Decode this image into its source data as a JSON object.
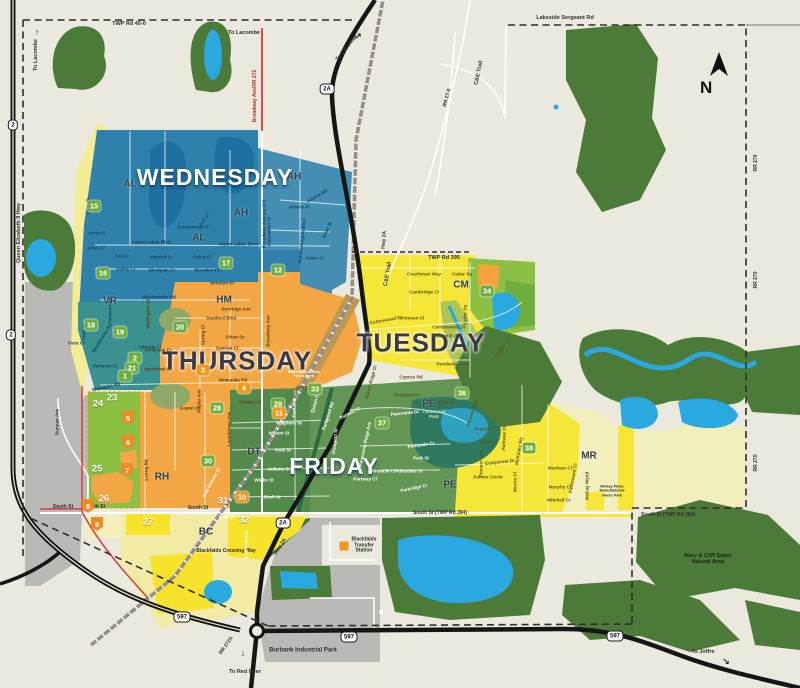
{
  "compass": {
    "letter": "N"
  },
  "colors": {
    "background": "#ebe9dd",
    "wednesday_blue": "#2f81ab",
    "vr_teal": "#3b9190",
    "thursday_orange": "#f2a644",
    "tuesday_yellow": "#f6e637",
    "friday_green": "#639554",
    "pale_yellow": "#f3efbc",
    "park_green": "#8cc043",
    "forest_green": "#4c7a38",
    "water_blue": "#2aa9e0",
    "industrial_gray": "#b9b9b5",
    "red_road": "#d63b3b"
  },
  "labels": [
    {
      "t": "WEDNESDAY",
      "x": 215,
      "y": 178,
      "c": "W",
      "s": 23
    },
    {
      "t": "THURSDAY",
      "x": 237,
      "y": 361,
      "c": "D",
      "s": 26
    },
    {
      "t": "TUESDAY",
      "x": 421,
      "y": 343,
      "c": "D",
      "s": 26
    },
    {
      "t": "FRIDAY",
      "x": 334,
      "y": 467,
      "c": "W",
      "s": 23
    },
    {
      "t": "AL",
      "x": 130,
      "y": 184,
      "c": "Z",
      "s": 10
    },
    {
      "t": "AH",
      "x": 294,
      "y": 177,
      "c": "Z",
      "s": 10
    },
    {
      "t": "AH",
      "x": 241,
      "y": 213,
      "c": "Z",
      "s": 10
    },
    {
      "t": "AL",
      "x": 199,
      "y": 238,
      "c": "Z",
      "s": 10
    },
    {
      "t": "VR",
      "x": 110,
      "y": 301,
      "c": "Z",
      "s": 10
    },
    {
      "t": "HM",
      "x": 224,
      "y": 300,
      "c": "Z",
      "s": 10
    },
    {
      "t": "CM",
      "x": 461,
      "y": 285,
      "c": "Z",
      "s": 10
    },
    {
      "t": "DT",
      "x": 254,
      "y": 452,
      "c": "Z",
      "s": 10
    },
    {
      "t": "PE",
      "x": 429,
      "y": 404,
      "c": "Z",
      "s": 10
    },
    {
      "t": "PE",
      "x": 450,
      "y": 485,
      "c": "Z",
      "s": 10
    },
    {
      "t": "MR",
      "x": 589,
      "y": 456,
      "c": "Z",
      "s": 10
    },
    {
      "t": "RH",
      "x": 162,
      "y": 477,
      "c": "Z",
      "s": 10
    },
    {
      "t": "BC",
      "x": 206,
      "y": 532,
      "c": "Z",
      "s": 10
    },
    {
      "t": "TWP Rd 40-0",
      "x": 129,
      "y": 24,
      "c": "d",
      "s": 5.5
    },
    {
      "t": "Lakeside Sergeant Rd",
      "x": 565,
      "y": 18,
      "c": "d",
      "s": 5.5
    },
    {
      "t": "TWP Rd 395",
      "x": 444,
      "y": 258,
      "c": "d",
      "s": 5.5
    },
    {
      "t": "C&E Trail",
      "x": 479,
      "y": 73,
      "r": -78,
      "c": "d",
      "s": 5.5
    },
    {
      "t": "C&E Trail",
      "x": 388,
      "y": 274,
      "r": -80,
      "c": "d",
      "s": 5.5
    },
    {
      "t": "RR 27-0",
      "x": 448,
      "y": 98,
      "r": -75,
      "c": "d",
      "s": 5
    },
    {
      "t": "Queen Elizabeth II Hwy",
      "x": 19,
      "y": 233,
      "r": -90,
      "c": "d",
      "s": 5.5
    },
    {
      "t": "Hwy 2A",
      "x": 385,
      "y": 240,
      "r": -85,
      "c": "d",
      "s": 5
    },
    {
      "t": "Hwy 2A",
      "x": 281,
      "y": 547,
      "r": -58,
      "c": "d",
      "s": 5
    },
    {
      "t": "RR 270",
      "x": 757,
      "y": 163,
      "r": -90,
      "c": "d",
      "s": 5
    },
    {
      "t": "RR 270",
      "x": 757,
      "y": 280,
      "r": -90,
      "c": "d",
      "s": 5
    },
    {
      "t": "RR 270",
      "x": 757,
      "y": 463,
      "r": -90,
      "c": "d",
      "s": 5
    },
    {
      "t": "RR 272A",
      "x": 227,
      "y": 646,
      "r": -55,
      "c": "d",
      "s": 5
    },
    {
      "t": "South St",
      "x": 63,
      "y": 508,
      "c": "d",
      "s": 5
    },
    {
      "t": "South St",
      "x": 95,
      "y": 508,
      "c": "d",
      "s": 5
    },
    {
      "t": "South St",
      "x": 198,
      "y": 509,
      "c": "d",
      "s": 5
    },
    {
      "t": "South St (TWP Rd 394)",
      "x": 440,
      "y": 514,
      "c": "d",
      "s": 5
    },
    {
      "t": "South St (TWP Rd 394)",
      "x": 668,
      "y": 516,
      "c": "d",
      "s": 5
    },
    {
      "t": "Burbank Industrial Park",
      "x": 303,
      "y": 651,
      "c": "d",
      "s": 6
    },
    {
      "t": "Mary & Cliff Soper\nNatural Area",
      "x": 708,
      "y": 559,
      "c": "k",
      "s": 5.5
    },
    {
      "t": "To Lacombe",
      "x": 36,
      "y": 55,
      "r": -90,
      "c": "d",
      "s": 5.5
    },
    {
      "t": "↑",
      "x": 37,
      "y": 32,
      "c": "d",
      "s": 9
    },
    {
      "t": "To Lacombe",
      "x": 244,
      "y": 33,
      "c": "d",
      "s": 5.5
    },
    {
      "t": "To Lacombe",
      "x": 347,
      "y": 48,
      "r": -52,
      "c": "d",
      "s": 5.5
    },
    {
      "t": "↗",
      "x": 358,
      "y": 36,
      "c": "d",
      "s": 9
    },
    {
      "t": "To Red Deer",
      "x": 245,
      "y": 672,
      "c": "d",
      "s": 5.5
    },
    {
      "t": "↓",
      "x": 243,
      "y": 653,
      "c": "d",
      "s": 9
    },
    {
      "t": "To Joffre",
      "x": 703,
      "y": 652,
      "c": "d",
      "s": 5.5
    },
    {
      "t": "↘",
      "x": 726,
      "y": 661,
      "c": "d",
      "s": 9
    },
    {
      "t": "Broadway Ave/RR 272",
      "x": 256,
      "y": 96,
      "r": -90,
      "c": "r",
      "s": 5
    },
    {
      "t": "Blackfalds Crossing Way",
      "x": 226,
      "y": 552,
      "c": "d",
      "s": 5
    },
    {
      "t": "Blackfalds\nTransfer\nStation",
      "x": 364,
      "y": 546,
      "c": "d",
      "s": 5
    },
    {
      "t": "McKay Place\nManufactured\nHome Park",
      "x": 612,
      "y": 491,
      "c": "d",
      "s": 3.8
    },
    {
      "t": "Blackfalds Mobile\nHome Park",
      "x": 304,
      "y": 374,
      "c": "w",
      "s": 3.8
    },
    {
      "t": "Centennial\nPark",
      "x": 434,
      "y": 414,
      "c": "t",
      "s": 4.5
    },
    {
      "t": "Duncan Ave",
      "x": 57,
      "y": 422,
      "r": -90,
      "c": "d",
      "s": 4.6
    },
    {
      "t": "East Railway St",
      "x": 212,
      "y": 483,
      "r": -62,
      "c": "w",
      "s": 4.4
    },
    {
      "t": "Trout St",
      "x": 226,
      "y": 518,
      "c": "w",
      "s": 4.2
    },
    {
      "t": "Broadway Ave",
      "x": 247,
      "y": 545,
      "r": -90,
      "c": "w",
      "s": 4.2
    },
    {
      "t": "Vista Tr",
      "x": 88,
      "y": 206,
      "r": -90,
      "c": "b",
      "s": 4.6
    },
    {
      "t": "Anna Cl",
      "x": 97,
      "y": 233,
      "c": "b",
      "s": 4.6
    },
    {
      "t": "Arlen Cl",
      "x": 96,
      "y": 248,
      "c": "b",
      "s": 4.6
    },
    {
      "t": "Vista Tr",
      "x": 84,
      "y": 332,
      "r": -90,
      "c": "b",
      "s": 4.6
    },
    {
      "t": "Aspen Lakes Blvd",
      "x": 151,
      "y": 242,
      "c": "b",
      "s": 4.6
    },
    {
      "t": "Aspen Lakes Blvd",
      "x": 238,
      "y": 244,
      "c": "b",
      "s": 4.6
    },
    {
      "t": "Ava Cr",
      "x": 122,
      "y": 256,
      "c": "b",
      "s": 4.6
    },
    {
      "t": "Valley Cr",
      "x": 126,
      "y": 269,
      "c": "b",
      "s": 4.6
    },
    {
      "t": "Almond Cr",
      "x": 161,
      "y": 257,
      "c": "b",
      "s": 4.6
    },
    {
      "t": "Westgate Cr",
      "x": 162,
      "y": 270,
      "c": "b",
      "s": 4.6
    },
    {
      "t": "Adina Cl",
      "x": 202,
      "y": 257,
      "c": "b",
      "s": 4.6
    },
    {
      "t": "Woodbine Cl",
      "x": 208,
      "y": 270,
      "c": "b",
      "s": 4.6
    },
    {
      "t": "Arrowwood Cl",
      "x": 193,
      "y": 227,
      "c": "b",
      "s": 4.6
    },
    {
      "t": "Asti Cl",
      "x": 204,
      "y": 220,
      "r": -55,
      "c": "b",
      "s": 4.6
    },
    {
      "t": "Athens Rd",
      "x": 317,
      "y": 196,
      "r": -30,
      "c": "b",
      "s": 4.6
    },
    {
      "t": "Athens Pl",
      "x": 299,
      "y": 207,
      "c": "b",
      "s": 4.6
    },
    {
      "t": "Aurora Heights Blvd",
      "x": 302,
      "y": 241,
      "r": -84,
      "c": "b",
      "s": 4.6
    },
    {
      "t": "Aztec St",
      "x": 327,
      "y": 230,
      "r": -65,
      "c": "b",
      "s": 4.6
    },
    {
      "t": "Aztec Cr",
      "x": 315,
      "y": 258,
      "c": "b",
      "s": 4.6
    },
    {
      "t": "Alderwood Cl",
      "x": 269,
      "y": 232,
      "r": -90,
      "c": "b",
      "s": 4.6
    },
    {
      "t": "Broadway Avenue 272",
      "x": 264,
      "y": 224,
      "r": -90,
      "c": "b",
      "s": 4.6
    },
    {
      "t": "Westbrooke Rd",
      "x": 159,
      "y": 297,
      "c": "b",
      "s": 4.6
    },
    {
      "t": "Winston Pl",
      "x": 222,
      "y": 283,
      "c": "b",
      "s": 4.6
    },
    {
      "t": "Westbrooke Rd",
      "x": 102,
      "y": 338,
      "r": -58,
      "c": "b",
      "s": 4.6
    },
    {
      "t": "Vermont St",
      "x": 110,
      "y": 311,
      "r": -90,
      "c": "b",
      "s": 4.6
    },
    {
      "t": "Vintage Cl",
      "x": 150,
      "y": 347,
      "c": "b",
      "s": 4.6
    },
    {
      "t": "Vermont Cl",
      "x": 105,
      "y": 366,
      "c": "b",
      "s": 4.6
    },
    {
      "t": "Vista Cl",
      "x": 76,
      "y": 343,
      "c": "b",
      "s": 4.6
    },
    {
      "t": "Womacks Rd",
      "x": 106,
      "y": 387,
      "r": -12,
      "c": "b",
      "s": 4.6
    },
    {
      "t": "Wellington Cl",
      "x": 148,
      "y": 314,
      "r": -90,
      "c": "o",
      "s": 4.6
    },
    {
      "t": "Sunridge Ave",
      "x": 236,
      "y": 309,
      "c": "o",
      "s": 4.6
    },
    {
      "t": "Stanford Blvd",
      "x": 221,
      "y": 318,
      "c": "o",
      "s": 4.6
    },
    {
      "t": "Silver Dr",
      "x": 235,
      "y": 337,
      "c": "o",
      "s": 4.6
    },
    {
      "t": "Sunrise Cl",
      "x": 227,
      "y": 348,
      "c": "o",
      "s": 4.6
    },
    {
      "t": "Spring Cl",
      "x": 203,
      "y": 335,
      "r": -90,
      "c": "o",
      "s": 4.6
    },
    {
      "t": "Westview Cr",
      "x": 158,
      "y": 350,
      "c": "o",
      "s": 4.6
    },
    {
      "t": "Westview Cr",
      "x": 158,
      "y": 369,
      "c": "o",
      "s": 4.6
    },
    {
      "t": "Womacks Rd",
      "x": 233,
      "y": 380,
      "c": "o",
      "s": 4.6
    },
    {
      "t": "Gregg St",
      "x": 306,
      "y": 387,
      "c": "o",
      "s": 4.6
    },
    {
      "t": "Aspen Dr",
      "x": 190,
      "y": 408,
      "c": "o",
      "s": 4.6
    },
    {
      "t": "Poplar Ave",
      "x": 199,
      "y": 401,
      "r": -90,
      "c": "o",
      "s": 4.6
    },
    {
      "t": "Stanley St",
      "x": 250,
      "y": 402,
      "c": "o",
      "s": 4.6
    },
    {
      "t": "Broadway Ave",
      "x": 268,
      "y": 331,
      "r": -90,
      "c": "o",
      "s": 4.6
    },
    {
      "t": "Leung Rd",
      "x": 146,
      "y": 470,
      "r": -90,
      "c": "o",
      "s": 4.6
    },
    {
      "t": "Lansdowne Ave",
      "x": 229,
      "y": 429,
      "r": -90,
      "c": "o",
      "s": 4.6
    },
    {
      "t": "Coachman Way",
      "x": 424,
      "y": 274,
      "c": "y",
      "s": 4.6
    },
    {
      "t": "Cedar Sq",
      "x": 462,
      "y": 274,
      "c": "y",
      "s": 4.6
    },
    {
      "t": "Cambridge Cl",
      "x": 424,
      "y": 292,
      "c": "y",
      "s": 4.6
    },
    {
      "t": "Crimson Cl",
      "x": 412,
      "y": 318,
      "c": "y",
      "s": 4.6
    },
    {
      "t": "Cottonwood Dr",
      "x": 386,
      "y": 320,
      "r": -10,
      "c": "y",
      "s": 4.6
    },
    {
      "t": "Cottonwood Dr",
      "x": 449,
      "y": 327,
      "c": "y",
      "s": 4.6
    },
    {
      "t": "Churchill Pl",
      "x": 445,
      "y": 336,
      "c": "y",
      "s": 4.6
    },
    {
      "t": "Cedar Sq",
      "x": 465,
      "y": 315,
      "r": -90,
      "c": "y",
      "s": 4.6
    },
    {
      "t": "Cooper Cl",
      "x": 502,
      "y": 348,
      "r": -55,
      "c": "y",
      "s": 4.6
    },
    {
      "t": "Ponderosa Ave",
      "x": 453,
      "y": 364,
      "c": "y",
      "s": 4.6
    },
    {
      "t": "Cyprus Rd",
      "x": 411,
      "y": 377,
      "c": "y",
      "s": 4.6
    },
    {
      "t": "Prairie Ridge Cr",
      "x": 371,
      "y": 382,
      "r": -75,
      "c": "y",
      "s": 4.6
    },
    {
      "t": "Pine Cr",
      "x": 447,
      "y": 402,
      "c": "y",
      "s": 4.6
    },
    {
      "t": "Pinetree Cl",
      "x": 486,
      "y": 429,
      "c": "y",
      "s": 4.6
    },
    {
      "t": "Piper Cl",
      "x": 489,
      "y": 442,
      "c": "y",
      "s": 4.6
    },
    {
      "t": "Pioneer Ave",
      "x": 481,
      "y": 464,
      "r": -90,
      "c": "y",
      "s": 4.6
    },
    {
      "t": "Pioneer Way",
      "x": 472,
      "y": 413,
      "r": -72,
      "c": "y",
      "s": 4.6
    },
    {
      "t": "Parkway Dr",
      "x": 504,
      "y": 438,
      "r": -88,
      "c": "y",
      "s": 4.6
    },
    {
      "t": "McKinley Wy",
      "x": 519,
      "y": 451,
      "r": -80,
      "c": "y",
      "s": 4.6
    },
    {
      "t": "Eastpointe Dr",
      "x": 500,
      "y": 462,
      "r": -6,
      "c": "y",
      "s": 4.6
    },
    {
      "t": "Morris Cl",
      "x": 515,
      "y": 482,
      "r": -90,
      "c": "y",
      "s": 4.6
    },
    {
      "t": "Palmer Circle",
      "x": 488,
      "y": 477,
      "c": "y",
      "s": 4.6
    },
    {
      "t": "Maclean Cl",
      "x": 560,
      "y": 468,
      "c": "y",
      "s": 4.6
    },
    {
      "t": "Murphy Cl",
      "x": 560,
      "y": 487,
      "c": "y",
      "s": 4.6
    },
    {
      "t": "Mitchell Cr",
      "x": 559,
      "y": 500,
      "c": "y",
      "s": 4.6
    },
    {
      "t": "McKay Wynd",
      "x": 587,
      "y": 486,
      "r": -90,
      "c": "y",
      "s": 4.6
    },
    {
      "t": "Parkmount Cr",
      "x": 573,
      "y": 478,
      "r": -80,
      "c": "y",
      "s": 4.6
    },
    {
      "t": "Plumtree Cr",
      "x": 407,
      "y": 395,
      "c": "y",
      "s": 4.6
    },
    {
      "t": "Waghorn St",
      "x": 289,
      "y": 423,
      "c": "w",
      "s": 4.6
    },
    {
      "t": "Wilson St",
      "x": 279,
      "y": 433,
      "c": "w",
      "s": 4.6
    },
    {
      "t": "Park St",
      "x": 283,
      "y": 450,
      "c": "w",
      "s": 4.6
    },
    {
      "t": "Indiana St",
      "x": 279,
      "y": 469,
      "c": "w",
      "s": 4.6
    },
    {
      "t": "Winks St",
      "x": 264,
      "y": 480,
      "c": "w",
      "s": 4.6
    },
    {
      "t": "Shull St",
      "x": 272,
      "y": 497,
      "c": "w",
      "s": 4.6
    },
    {
      "t": "East Ave",
      "x": 294,
      "y": 408,
      "r": -90,
      "c": "w",
      "s": 4.6
    },
    {
      "t": "Queen Cl",
      "x": 315,
      "y": 403,
      "r": -75,
      "c": "w",
      "s": 4.6
    },
    {
      "t": "Parkwood Rd",
      "x": 328,
      "y": 416,
      "r": -72,
      "c": "w",
      "s": 4.6
    },
    {
      "t": "Prospect St",
      "x": 335,
      "y": 441,
      "r": -85,
      "c": "w",
      "s": 4.6
    },
    {
      "t": "Pamela Cr",
      "x": 350,
      "y": 413,
      "r": -28,
      "c": "w",
      "s": 4.6
    },
    {
      "t": "Panorama Dr",
      "x": 405,
      "y": 413,
      "r": -6,
      "c": "w",
      "s": 4.6
    },
    {
      "t": "Panorama Ridge Ave",
      "x": 365,
      "y": 444,
      "r": -78,
      "c": "w",
      "s": 4.6
    },
    {
      "t": "Pinnacle Cl",
      "x": 383,
      "y": 471,
      "c": "w",
      "s": 4.6
    },
    {
      "t": "Portway Cl",
      "x": 365,
      "y": 479,
      "c": "w",
      "s": 4.6
    },
    {
      "t": "Palisades St",
      "x": 409,
      "y": 471,
      "c": "w",
      "s": 4.6
    },
    {
      "t": "Parkridge Cr",
      "x": 414,
      "y": 488,
      "r": -12,
      "c": "w",
      "s": 4.6
    },
    {
      "t": "Pondside Cr",
      "x": 421,
      "y": 445,
      "r": -8,
      "c": "w",
      "s": 4.6
    },
    {
      "t": "Park St",
      "x": 421,
      "y": 458,
      "c": "w",
      "s": 4.6
    }
  ],
  "markers": {
    "green": [
      {
        "n": "15",
        "x": 94,
        "y": 206
      },
      {
        "n": "16",
        "x": 103,
        "y": 273
      },
      {
        "n": "17",
        "x": 226,
        "y": 263
      },
      {
        "n": "12",
        "x": 278,
        "y": 270
      },
      {
        "n": "18",
        "x": 91,
        "y": 325
      },
      {
        "n": "19",
        "x": 120,
        "y": 332
      },
      {
        "n": "20",
        "x": 180,
        "y": 327
      },
      {
        "n": "2",
        "x": 135,
        "y": 358
      },
      {
        "n": "21",
        "x": 132,
        "y": 368
      },
      {
        "n": "1",
        "x": 125,
        "y": 376
      },
      {
        "n": "28",
        "x": 217,
        "y": 408
      },
      {
        "n": "29",
        "x": 278,
        "y": 404
      },
      {
        "n": "30",
        "x": 208,
        "y": 461
      },
      {
        "n": "33",
        "x": 315,
        "y": 389
      },
      {
        "n": "34",
        "x": 487,
        "y": 291
      },
      {
        "n": "36",
        "x": 462,
        "y": 393
      },
      {
        "n": "37",
        "x": 382,
        "y": 423
      },
      {
        "n": "38",
        "x": 529,
        "y": 448
      }
    ],
    "orange": [
      {
        "n": "3",
        "x": 203,
        "y": 370
      },
      {
        "n": "4",
        "x": 244,
        "y": 388
      },
      {
        "n": "11",
        "x": 279,
        "y": 413
      },
      {
        "n": "10",
        "x": 242,
        "y": 497
      }
    ],
    "shield": [
      {
        "n": "5",
        "x": 128,
        "y": 418
      },
      {
        "n": "6",
        "x": 128,
        "y": 442
      },
      {
        "n": "7",
        "x": 127,
        "y": 470
      },
      {
        "n": "8",
        "x": 88,
        "y": 506
      },
      {
        "n": "9",
        "x": 97,
        "y": 524
      }
    ],
    "plain": [
      {
        "n": "24",
        "x": 98,
        "y": 404
      },
      {
        "n": "23",
        "x": 112,
        "y": 398
      },
      {
        "n": "25",
        "x": 97,
        "y": 469
      },
      {
        "n": "26",
        "x": 104,
        "y": 499
      },
      {
        "n": "27",
        "x": 148,
        "y": 522
      },
      {
        "n": "31",
        "x": 223,
        "y": 501
      },
      {
        "n": "32",
        "x": 244,
        "y": 520
      }
    ]
  },
  "highway_shields": [
    {
      "t": "2A",
      "x": 327,
      "y": 89
    },
    {
      "t": "2A",
      "x": 283,
      "y": 523
    },
    {
      "t": "597",
      "x": 349,
      "y": 637
    },
    {
      "t": "597",
      "x": 615,
      "y": 636
    },
    {
      "t": "597",
      "x": 182,
      "y": 617
    },
    {
      "t": "2",
      "x": 13,
      "y": 125
    },
    {
      "t": "2",
      "x": 11,
      "y": 335
    }
  ],
  "poi_icons": [
    {
      "name": "transfer-station-square",
      "x": 344,
      "y": 546,
      "color": "#f09a1e"
    }
  ]
}
